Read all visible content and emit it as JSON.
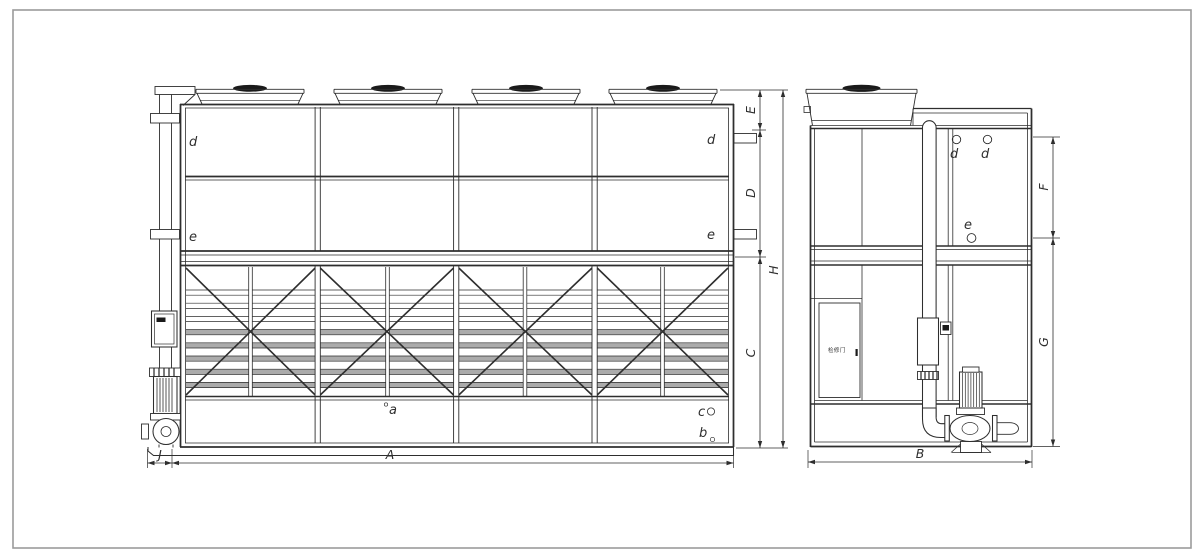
{
  "colors": {
    "line": "#2e2e2e",
    "louver": "#ababab",
    "fan_cap": "#1a1a1a",
    "border": "#9b9b9b",
    "background": "#ffffff"
  },
  "front_view": {
    "connections": {
      "d_left": "d",
      "e_left": "e",
      "d_right": "d",
      "e_right": "e"
    },
    "points": {
      "a": "a",
      "b": "b",
      "c": "c"
    },
    "dimensions": {
      "A": "A",
      "C": "C",
      "D": "D",
      "E": "E",
      "H": "H",
      "J": "J"
    }
  },
  "side_view": {
    "connections": {
      "d_front": "d",
      "d_rear": "d",
      "e": "e"
    },
    "door_label": "检修门",
    "dimensions": {
      "B": "B",
      "F": "F",
      "G": "G"
    }
  }
}
